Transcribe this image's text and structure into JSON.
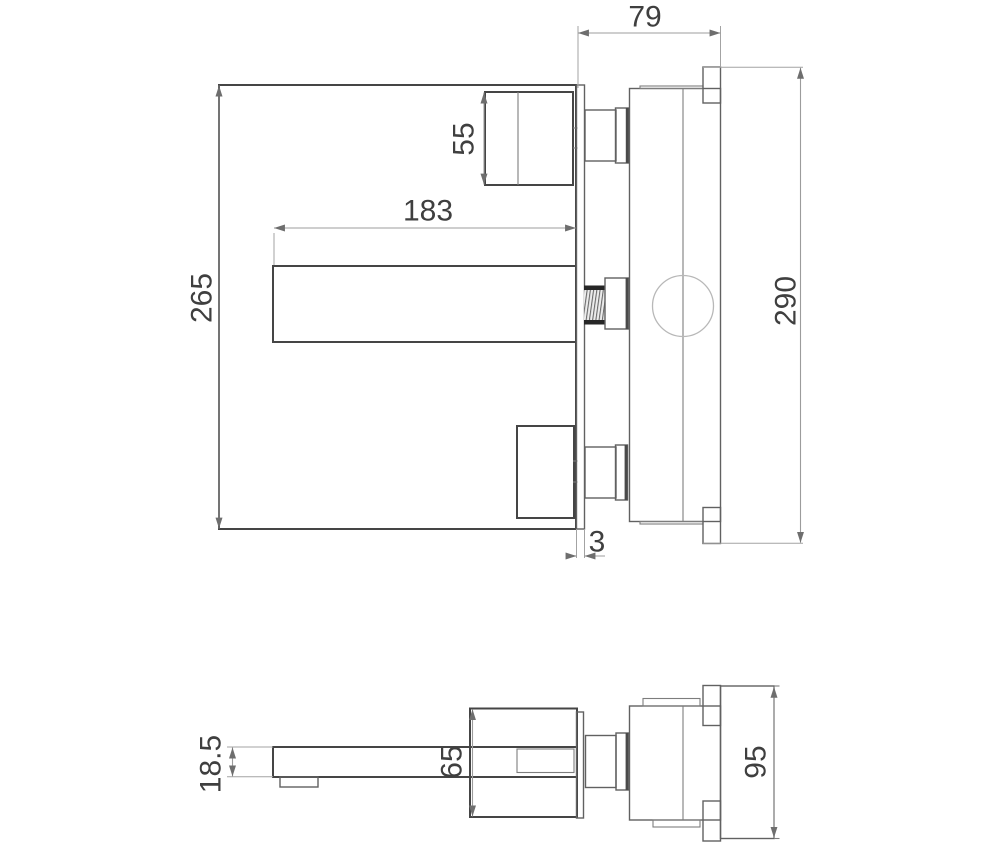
{
  "drawing": {
    "views": {
      "front_side_view": {
        "dim_depth": "79",
        "dim_handle": "55",
        "dim_spout_length": "183",
        "dim_plate_height": "265",
        "dim_body_height": "290",
        "dim_wall_plate_thickness": "3"
      },
      "bottom_view": {
        "dim_spout_height": "18.5",
        "dim_escutcheon_height": "65",
        "dim_trim_height": "95"
      }
    },
    "colors": {
      "outline": "#454545",
      "detail": "#6b6b6b",
      "dimension_lines": "#9c9c9c",
      "text": "#3f3f3f"
    }
  }
}
